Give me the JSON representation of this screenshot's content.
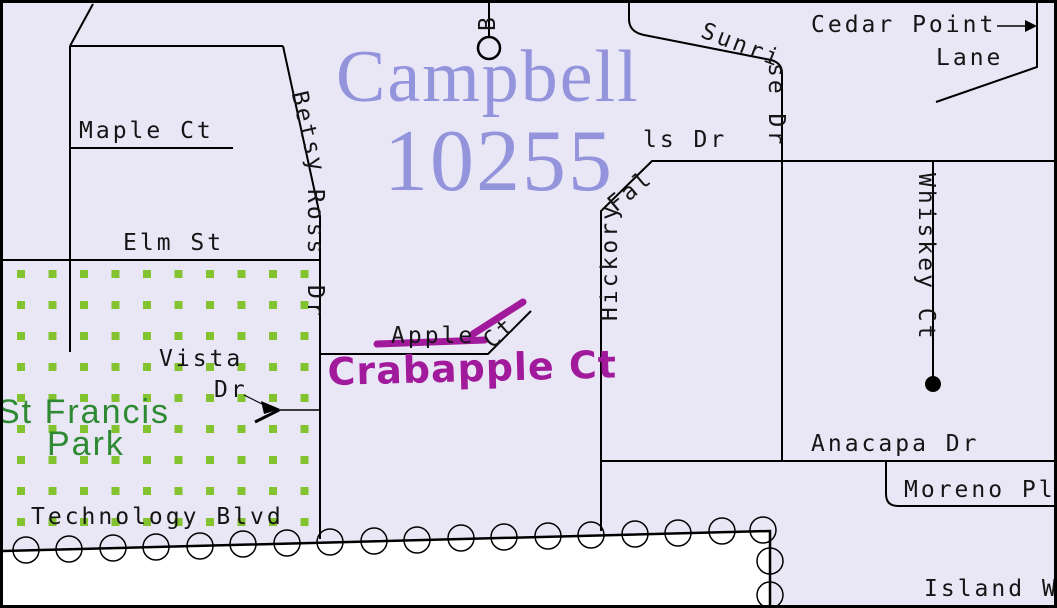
{
  "title": {
    "line1": "Campbell",
    "line2": "10255"
  },
  "park": {
    "line1": "St Francis",
    "line2": "Park"
  },
  "annotation": {
    "text": "Crabapple Ct"
  },
  "streets": {
    "maple_ct": "Maple Ct",
    "elm_st": "Elm St",
    "betsy_ross_seg1": "Betsy",
    "betsy_ross_seg2": "Ross",
    "betsy_ross_seg3": "Dr",
    "b_partial": "B",
    "sunrise_seg1": "Sunri",
    "sunrise_seg2": "se Dr",
    "cedar_point_line1": "Cedar Point",
    "cedar_point_line2": "Lane",
    "hickory_seg1": "Hickory",
    "hickory_seg2": "Fal",
    "hickory_seg3": "ls Dr",
    "whiskey_ct": "Whiskey Ct",
    "anacapa_dr": "Anacapa Dr",
    "moreno_pl": "Moreno Pl",
    "island_w": "Island W",
    "technology_blvd": "Technology Blvd",
    "vista_line1": "Vista",
    "vista_line2": "Dr",
    "apple_seg1": "Apple",
    "apple_seg2": "Ct"
  },
  "colors": {
    "background": "#E9E7F6",
    "road": "#000000",
    "title_text": "#9494DC",
    "park_dot": "#82C32F",
    "park_text": "#2E8A32",
    "annotation": "#A11A9C",
    "outside_area": "#FFFFFF"
  }
}
